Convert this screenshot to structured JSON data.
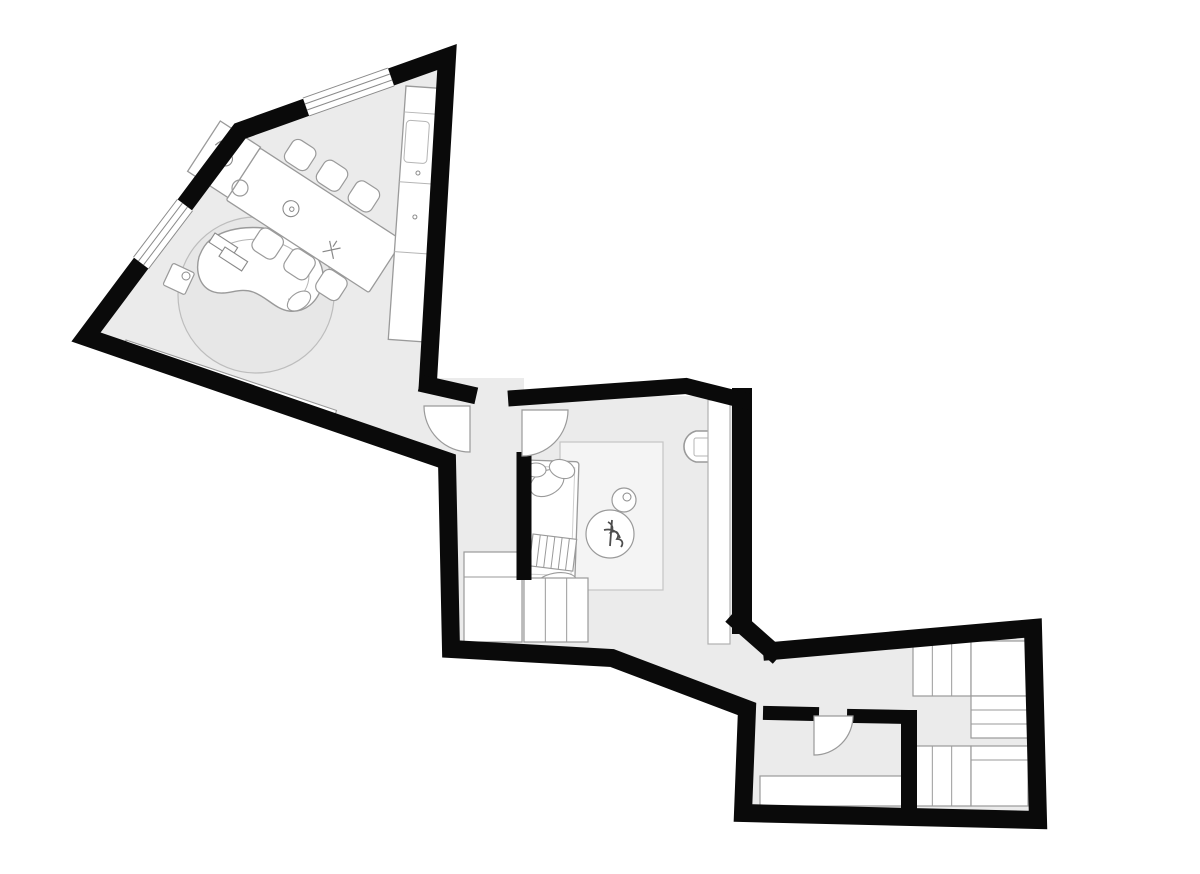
{
  "meta": {
    "canvas": {
      "w": 1200,
      "h": 874
    }
  },
  "plan": {
    "colors": {
      "wall": "#0a0a0a",
      "line": "#9a9a9a",
      "light": "#bfbfbf",
      "floor": "#ebebeb",
      "white": "#ffffff",
      "plant": "#4d4d4d"
    },
    "shapes": [
      {
        "name": "floor-living-room",
        "t": "poly",
        "pts": [
          [
            447,
            57
          ],
          [
            240,
            131
          ],
          [
            86,
            337
          ],
          [
            447,
            461
          ],
          [
            432,
            381
          ]
        ],
        "fill": "#ebebeb"
      },
      {
        "name": "floor-hallway",
        "t": "poly",
        "pts": [
          [
            428,
            378
          ],
          [
            524,
            378
          ],
          [
            524,
            650
          ],
          [
            449,
            650
          ],
          [
            445,
            458
          ]
        ],
        "fill": "#ebebeb"
      },
      {
        "name": "floor-bedroom",
        "t": "poly",
        "pts": [
          [
            516,
            396
          ],
          [
            742,
            396
          ],
          [
            742,
            622
          ],
          [
            766,
            646
          ],
          [
            748,
            710
          ],
          [
            614,
            658
          ],
          [
            516,
            650
          ]
        ],
        "fill": "#ebebeb"
      },
      {
        "name": "floor-dressing-room",
        "t": "poly",
        "pts": [
          [
            744,
            656
          ],
          [
            770,
            648
          ],
          [
            1033,
            628
          ],
          [
            1036,
            818
          ],
          [
            744,
            812
          ]
        ],
        "fill": "#ebebeb"
      },
      {
        "name": "round-rug",
        "t": "circle",
        "cx": 256,
        "cy": 295,
        "r": 78,
        "fill": "#e7e7e7",
        "stroke": "#bdbdbd",
        "sw": 1.2
      },
      {
        "name": "wall-bench",
        "t": "rect",
        "x": 126,
        "y": 340,
        "w": 222,
        "h": 13,
        "fill": "#ffffff",
        "stroke": "#9a9a9a",
        "sw": 1.1,
        "tf": "rotate(18.5 126 340)"
      },
      {
        "name": "curved-sofa",
        "t": "path",
        "d": "M210,240 C228,226 262,223 288,235 C313,246 327,264 322,285 C318,302 305,313 289,311 C275,309 267,297 253,292 C239,287 227,296 214,292 C200,288 195,272 199,257 C202,249 205,244 210,240 Z",
        "fill": "#ffffff",
        "stroke": "#9a9a9a",
        "sw": 1.4
      },
      {
        "name": "curved-sofa-seat-line",
        "t": "path",
        "d": "M221,248 C238,238 263,236 284,245 C302,253 312,268 308,283 C305,294 297,301 288,299",
        "stroke": "#b5b5b5",
        "sw": 1
      },
      {
        "name": "sofa-armrest",
        "t": "ellipse",
        "cx": 299,
        "cy": 301,
        "rx": 13,
        "ry": 8,
        "fill": "#ffffff",
        "stroke": "#9a9a9a",
        "sw": 1.1,
        "tf": "rotate(-35 299 301)"
      },
      {
        "name": "books-on-sofa-1",
        "t": "rect",
        "x": 215,
        "y": 233,
        "w": 27,
        "h": 11,
        "fill": "#ffffff",
        "stroke": "#8a8a8a",
        "sw": 1.1,
        "tf": "rotate(33 215 233)"
      },
      {
        "name": "books-on-sofa-2",
        "t": "rect",
        "x": 225,
        "y": 247,
        "w": 27,
        "h": 11,
        "fill": "#ffffff",
        "stroke": "#8a8a8a",
        "sw": 1.1,
        "tf": "rotate(33 225 247)"
      },
      {
        "name": "side-table-square",
        "t": "rect",
        "x": 173,
        "y": 263,
        "w": 24,
        "h": 24,
        "rx": 2,
        "fill": "#ffffff",
        "stroke": "#9a9a9a",
        "sw": 1.2,
        "tf": "rotate(25 173 263)"
      },
      {
        "name": "side-table-cup",
        "t": "circle",
        "cx": 186,
        "cy": 276,
        "r": 4,
        "stroke": "#8a8a8a",
        "sw": 1
      },
      {
        "name": "dining-chair-1",
        "t": "rect",
        "x": 284,
        "y": 119,
        "w": 27,
        "h": 26,
        "rx": 7,
        "fill": "#ffffff",
        "stroke": "#9a9a9a",
        "sw": 1.2,
        "tf": "rotate(33 260 148)"
      },
      {
        "name": "dining-chair-2",
        "t": "rect",
        "x": 322,
        "y": 119,
        "w": 27,
        "h": 26,
        "rx": 7,
        "fill": "#ffffff",
        "stroke": "#9a9a9a",
        "sw": 1.2,
        "tf": "rotate(33 260 148)"
      },
      {
        "name": "dining-chair-3",
        "t": "rect",
        "x": 360,
        "y": 119,
        "w": 27,
        "h": 26,
        "rx": 7,
        "fill": "#ffffff",
        "stroke": "#9a9a9a",
        "sw": 1.2,
        "tf": "rotate(33 260 148)"
      },
      {
        "name": "dining-chair-4",
        "t": "rect",
        "x": 305,
        "y": 211,
        "w": 27,
        "h": 26,
        "rx": 7,
        "fill": "#ffffff",
        "stroke": "#9a9a9a",
        "sw": 1.2,
        "tf": "rotate(33 260 148)"
      },
      {
        "name": "dining-chair-5",
        "t": "rect",
        "x": 343,
        "y": 211,
        "w": 27,
        "h": 26,
        "rx": 7,
        "fill": "#ffffff",
        "stroke": "#9a9a9a",
        "sw": 1.2,
        "tf": "rotate(33 260 148)"
      },
      {
        "name": "dining-chair-6",
        "t": "rect",
        "x": 381,
        "y": 211,
        "w": 27,
        "h": 26,
        "rx": 7,
        "fill": "#ffffff",
        "stroke": "#9a9a9a",
        "sw": 1.2,
        "tf": "rotate(33 260 148)"
      },
      {
        "name": "dining-table",
        "t": "rect",
        "x": 260,
        "y": 148,
        "w": 170,
        "h": 62,
        "rx": 2,
        "fill": "#ffffff",
        "stroke": "#9a9a9a",
        "sw": 1.3,
        "tf": "rotate(33 260 148)"
      },
      {
        "name": "table-end-unit",
        "t": "rect",
        "x": 212,
        "y": 147,
        "w": 48,
        "h": 60,
        "fill": "#ffffff",
        "stroke": "#9a9a9a",
        "sw": 1.3,
        "tf": "rotate(33 260 148)"
      },
      {
        "name": "faucet-icon",
        "t": "path",
        "d": "M221,170 c2,-9 9,-14 16,-10 m-8,-4 l-4,14",
        "stroke": "#8a8a8a",
        "sw": 1.2,
        "tf": "rotate(33 260 148)"
      },
      {
        "name": "place-setting-icon-1",
        "t": "circle",
        "cx": 237,
        "cy": 176,
        "r": 7,
        "stroke": "#8a8a8a",
        "sw": 1.1,
        "tf": "rotate(33 260 148)"
      },
      {
        "name": "place-setting-icon-1-dot",
        "t": "circle",
        "cx": 238,
        "cy": 176,
        "r": 2,
        "stroke": "#8a8a8a",
        "sw": 1,
        "tf": "rotate(33 260 148)"
      },
      {
        "name": "place-setting-icon-2",
        "t": "circle",
        "cx": 319,
        "cy": 182,
        "r": 8,
        "stroke": "#8a8a8a",
        "sw": 1.1,
        "tf": "rotate(33 260 148)"
      },
      {
        "name": "place-setting-icon-2-dot",
        "t": "circle",
        "cx": 320,
        "cy": 182,
        "r": 2.2,
        "stroke": "#8a8a8a",
        "sw": 1,
        "tf": "rotate(33 260 148)"
      },
      {
        "name": "cutlery-icon",
        "t": "path",
        "d": "M369,188 l13,13 M382,188 l-13,13 M375,184 v7",
        "stroke": "#888888",
        "sw": 1.2,
        "tf": "rotate(33 260 148)"
      },
      {
        "name": "stool",
        "t": "circle",
        "cx": 240,
        "cy": 188,
        "r": 8,
        "stroke": "#9a9a9a",
        "sw": 1.2
      },
      {
        "name": "kitchen-counter",
        "t": "rect",
        "x": 406,
        "y": 86,
        "w": 38,
        "h": 254,
        "fill": "#ffffff",
        "stroke": "#9a9a9a",
        "sw": 1.3,
        "tf": "rotate(4 406 86)"
      },
      {
        "name": "counter-divider-1",
        "t": "line",
        "x1": 406,
        "y1": 112,
        "x2": 444,
        "y2": 112,
        "stroke": "#b5b5b5",
        "sw": 1,
        "tf": "rotate(4 406 86)"
      },
      {
        "name": "counter-divider-2",
        "t": "line",
        "x1": 406,
        "y1": 182,
        "x2": 444,
        "y2": 182,
        "stroke": "#b5b5b5",
        "sw": 1,
        "tf": "rotate(4 406 86)"
      },
      {
        "name": "counter-divider-3",
        "t": "line",
        "x1": 406,
        "y1": 252,
        "x2": 444,
        "y2": 252,
        "stroke": "#b5b5b5",
        "sw": 1,
        "tf": "rotate(4 406 86)"
      },
      {
        "name": "counter-sink",
        "t": "rect",
        "x": 409,
        "y": 120,
        "w": 23,
        "h": 42,
        "rx": 4,
        "stroke": "#b5b5b5",
        "sw": 1,
        "tf": "rotate(4 406 86)"
      },
      {
        "name": "cabinet-handle-1",
        "t": "circle",
        "cx": 424,
        "cy": 172,
        "r": 2,
        "stroke": "#8a8a8a",
        "sw": 1,
        "tf": "rotate(4 406 86)"
      },
      {
        "name": "cabinet-handle-2",
        "t": "circle",
        "cx": 424,
        "cy": 216,
        "r": 2,
        "stroke": "#8a8a8a",
        "sw": 1,
        "tf": "rotate(4 406 86)"
      },
      {
        "name": "bedroom-rug",
        "t": "rect",
        "x": 560,
        "y": 442,
        "w": 103,
        "h": 148,
        "fill": "#f4f4f4",
        "stroke": "#c4c4c4",
        "sw": 1.2
      },
      {
        "name": "daybed",
        "t": "rect",
        "x": 527,
        "y": 460,
        "w": 52,
        "h": 120,
        "rx": 3,
        "fill": "#ffffff",
        "stroke": "#9a9a9a",
        "sw": 1.3,
        "tf": "rotate(2 527 460)"
      },
      {
        "name": "daybed-mattress-line",
        "t": "rect",
        "x": 532,
        "y": 466,
        "w": 43,
        "h": 108,
        "stroke": "#cfcfcf",
        "sw": 1,
        "tf": "rotate(2 527 460)"
      },
      {
        "name": "daybed-pillow-1",
        "t": "ellipse",
        "cx": 547,
        "cy": 483,
        "rx": 18,
        "ry": 12,
        "fill": "#ffffff",
        "stroke": "#9a9a9a",
        "sw": 1.1,
        "tf": "rotate(-28 547 483)"
      },
      {
        "name": "daybed-pillow-2",
        "t": "ellipse",
        "cx": 562,
        "cy": 469,
        "rx": 13,
        "ry": 9,
        "fill": "#ffffff",
        "stroke": "#9a9a9a",
        "sw": 1.1,
        "tf": "rotate(20 562 469)"
      },
      {
        "name": "daybed-pillow-3",
        "t": "ellipse",
        "cx": 536,
        "cy": 470,
        "rx": 10,
        "ry": 7,
        "fill": "#ffffff",
        "stroke": "#9a9a9a",
        "sw": 1.1
      },
      {
        "name": "striped-blanket",
        "t": "stripes",
        "x": 533,
        "y": 534,
        "w": 44,
        "h": 32,
        "n": 5,
        "tf": "rotate(7 533 534)"
      },
      {
        "name": "daybed-foot-cushion",
        "t": "ellipse",
        "cx": 556,
        "cy": 584,
        "rx": 21,
        "ry": 11,
        "fill": "#ffffff",
        "stroke": "#9a9a9a",
        "sw": 1.1,
        "tf": "rotate(-10 556 584)"
      },
      {
        "name": "coffee-table-round",
        "t": "circle",
        "cx": 610,
        "cy": 534,
        "r": 24,
        "fill": "#ffffff",
        "stroke": "#9a9a9a",
        "sw": 1.2
      },
      {
        "name": "plant-icon",
        "t": "path",
        "d": "M608,522 c4,2 6,6 3,10 c6,-2 9,2 6,7 c5,0 7,4 4,8 M612,520 l-2,26 M604,530 c8,-2 14,2 16,8",
        "stroke": "#4d4d4d",
        "sw": 1.8
      },
      {
        "name": "side-table-round",
        "t": "circle",
        "cx": 624,
        "cy": 500,
        "r": 12,
        "fill": "#ffffff",
        "stroke": "#9a9a9a",
        "sw": 1.2
      },
      {
        "name": "side-table-round-dish",
        "t": "circle",
        "cx": 627,
        "cy": 497,
        "r": 4,
        "stroke": "#8a8a8a",
        "sw": 1
      },
      {
        "name": "armchair",
        "t": "path",
        "d": "M710,431 H696 A16 16 0 0 0 696,462 H710",
        "fill": "#ffffff",
        "stroke": "#9a9a9a",
        "sw": 1.6
      },
      {
        "name": "armchair-seat",
        "t": "rect",
        "x": 694,
        "y": 438,
        "w": 16,
        "h": 18,
        "rx": 2,
        "fill": "#ffffff",
        "stroke": "#b5b5b5",
        "sw": 1
      },
      {
        "name": "console-shelf",
        "t": "rect",
        "x": 708,
        "y": 400,
        "w": 22,
        "h": 244,
        "fill": "#ffffff",
        "stroke": "#b0b0b0",
        "sw": 1.2
      },
      {
        "name": "closet-left",
        "t": "rect",
        "x": 464,
        "y": 552,
        "w": 58,
        "h": 90,
        "fill": "#ffffff",
        "stroke": "#9a9a9a",
        "sw": 1.2
      },
      {
        "name": "closet-left-shelf-line",
        "t": "line",
        "x1": 464,
        "y1": 577,
        "x2": 522,
        "y2": 577,
        "stroke": "#9a9a9a",
        "sw": 1
      },
      {
        "name": "closet-middle",
        "t": "stripes",
        "x": 524,
        "y": 578,
        "w": 64,
        "h": 64,
        "n": 2
      },
      {
        "name": "wardrobe-top",
        "t": "stripes",
        "x": 913,
        "y": 641,
        "w": 58,
        "h": 55,
        "n": 2
      },
      {
        "name": "cabinet-top",
        "t": "rect",
        "x": 971,
        "y": 641,
        "w": 57,
        "h": 55,
        "fill": "#ffffff",
        "stroke": "#9a9a9a",
        "sw": 1.2
      },
      {
        "name": "shelf-stack",
        "t": "stripes",
        "x": 971,
        "y": 696,
        "w": 57,
        "h": 42,
        "n": 2,
        "o": "h"
      },
      {
        "name": "wardrobe-bottom",
        "t": "stripes",
        "x": 913,
        "y": 746,
        "w": 58,
        "h": 60,
        "n": 2
      },
      {
        "name": "cabinet-bottom",
        "t": "rect",
        "x": 971,
        "y": 746,
        "w": 57,
        "h": 60,
        "fill": "#ffffff",
        "stroke": "#9a9a9a",
        "sw": 1.2
      },
      {
        "name": "cabinet-bottom-shelf-line",
        "t": "line",
        "x1": 971,
        "y1": 760,
        "x2": 1028,
        "y2": 760,
        "stroke": "#9a9a9a",
        "sw": 1
      },
      {
        "name": "wc-counter",
        "t": "rect",
        "x": 760,
        "y": 776,
        "w": 142,
        "h": 30,
        "fill": "#ffffff",
        "stroke": "#9a9a9a",
        "sw": 1.2
      },
      {
        "name": "wall-outer",
        "t": "pline",
        "pts": [
          [
            428,
            381
          ],
          [
            447,
            57
          ],
          [
            240,
            131
          ],
          [
            86,
            337
          ],
          [
            447,
            461
          ],
          [
            451,
            649
          ],
          [
            612,
            658
          ],
          [
            747,
            709
          ],
          [
            743,
            813
          ],
          [
            1038,
            820
          ],
          [
            1033,
            628
          ],
          [
            772,
            651
          ]
        ],
        "stroke": "#0a0a0a",
        "sw": 18,
        "cap": "square"
      },
      {
        "name": "wall-connector",
        "t": "pline",
        "pts": [
          [
            772,
            651
          ],
          [
            738,
            621
          ]
        ],
        "stroke": "#0a0a0a",
        "sw": 18,
        "cap": "square"
      },
      {
        "name": "wall-bedroom-right",
        "t": "pline",
        "pts": [
          [
            742,
            624
          ],
          [
            742,
            398
          ]
        ],
        "stroke": "#0a0a0a",
        "sw": 20,
        "cap": "square"
      },
      {
        "name": "wall-bedroom-top",
        "t": "pline",
        "pts": [
          [
            516,
            398
          ],
          [
            686,
            386
          ],
          [
            742,
            400
          ]
        ],
        "stroke": "#0a0a0a",
        "sw": 16,
        "cap": "square"
      },
      {
        "name": "wall-hall-stub",
        "t": "pline",
        "pts": [
          [
            428,
            385
          ],
          [
            468,
            394
          ]
        ],
        "stroke": "#0a0a0a",
        "sw": 17,
        "cap": "square"
      },
      {
        "name": "wall-hall-right",
        "t": "pline",
        "pts": [
          [
            524,
            452
          ],
          [
            524,
            580
          ]
        ],
        "stroke": "#0a0a0a",
        "sw": 15,
        "cap": "butt"
      },
      {
        "name": "wall-wc-top-left",
        "t": "pline",
        "pts": [
          [
            770,
            713
          ],
          [
            812,
            714
          ]
        ],
        "stroke": "#0a0a0a",
        "sw": 14,
        "cap": "square"
      },
      {
        "name": "wall-wc-top-right",
        "t": "pline",
        "pts": [
          [
            854,
            716
          ],
          [
            908,
            717
          ]
        ],
        "stroke": "#0a0a0a",
        "sw": 14,
        "cap": "square"
      },
      {
        "name": "wall-wc-right",
        "t": "pline",
        "pts": [
          [
            909,
            710
          ],
          [
            909,
            818
          ]
        ],
        "stroke": "#0a0a0a",
        "sw": 16,
        "cap": "butt"
      },
      {
        "name": "window-top",
        "t": "window",
        "x1": 391,
        "y1": 77,
        "x2": 306,
        "y2": 107,
        "w": 19
      },
      {
        "name": "window-left",
        "t": "window",
        "x1": 185,
        "y1": 205,
        "x2": 141,
        "y2": 263,
        "w": 19
      },
      {
        "name": "door-hall-left",
        "t": "path",
        "d": "M470,406 L424,406 A46 46 0 0 0 470,452 Z",
        "fill": "#ffffff",
        "stroke": "#9a9a9a",
        "sw": 1.2
      },
      {
        "name": "door-hall-right",
        "t": "path",
        "d": "M522,410 L568,410 A46 46 0 0 1 522,456 Z",
        "fill": "#ffffff",
        "stroke": "#9a9a9a",
        "sw": 1.2
      },
      {
        "name": "door-wc",
        "t": "path",
        "d": "M814,716 L814,755 A39 39 0 0 0 853,716 Z",
        "fill": "#ffffff",
        "stroke": "#9a9a9a",
        "sw": 1.2
      }
    ]
  }
}
